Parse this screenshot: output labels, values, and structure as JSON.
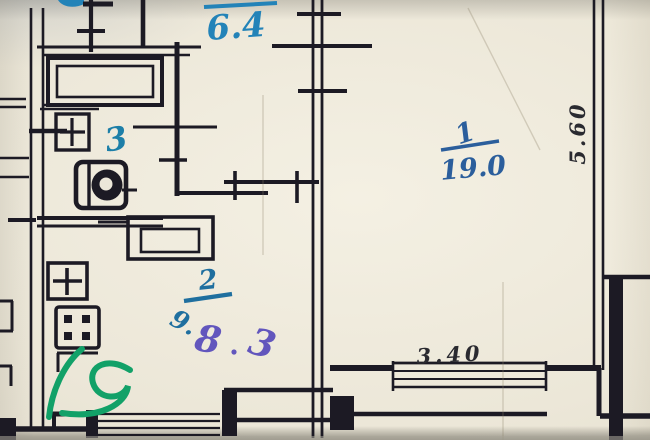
{
  "plan": {
    "kind": "scanned apartment floor plan (technical inventory drawing)",
    "rooms": {
      "kitchen": {
        "area": "6.4"
      },
      "bathroom": {
        "number": "3"
      },
      "room1": {
        "number": "1",
        "area": "19.0"
      },
      "room2": {
        "number": "2",
        "area_old": "9.",
        "area_corrected_1": "8",
        "area_corrected_2": "3"
      }
    },
    "dimensions": {
      "bottom_width": "3.40",
      "right_height": "5.60"
    },
    "annotations": {
      "green_mark": "9"
    },
    "colors": {
      "paper": "#ece7d9",
      "ink": "#1c1a24",
      "blue_ink": "#2383b8",
      "bath_blue_ink": "#1d7fa8",
      "navy_ink": "#2b5e9c",
      "room2_blue_ink": "#1f6f9f",
      "purple_ink": "#6256bd",
      "green_ink": "#12a168",
      "pencil_ink": "#2a2a30"
    },
    "fixtures": [
      "bathtub",
      "washbasin",
      "toilet",
      "kitchen-sink",
      "stove-4-burner",
      "built-in-closet",
      "window",
      "balcony"
    ]
  }
}
